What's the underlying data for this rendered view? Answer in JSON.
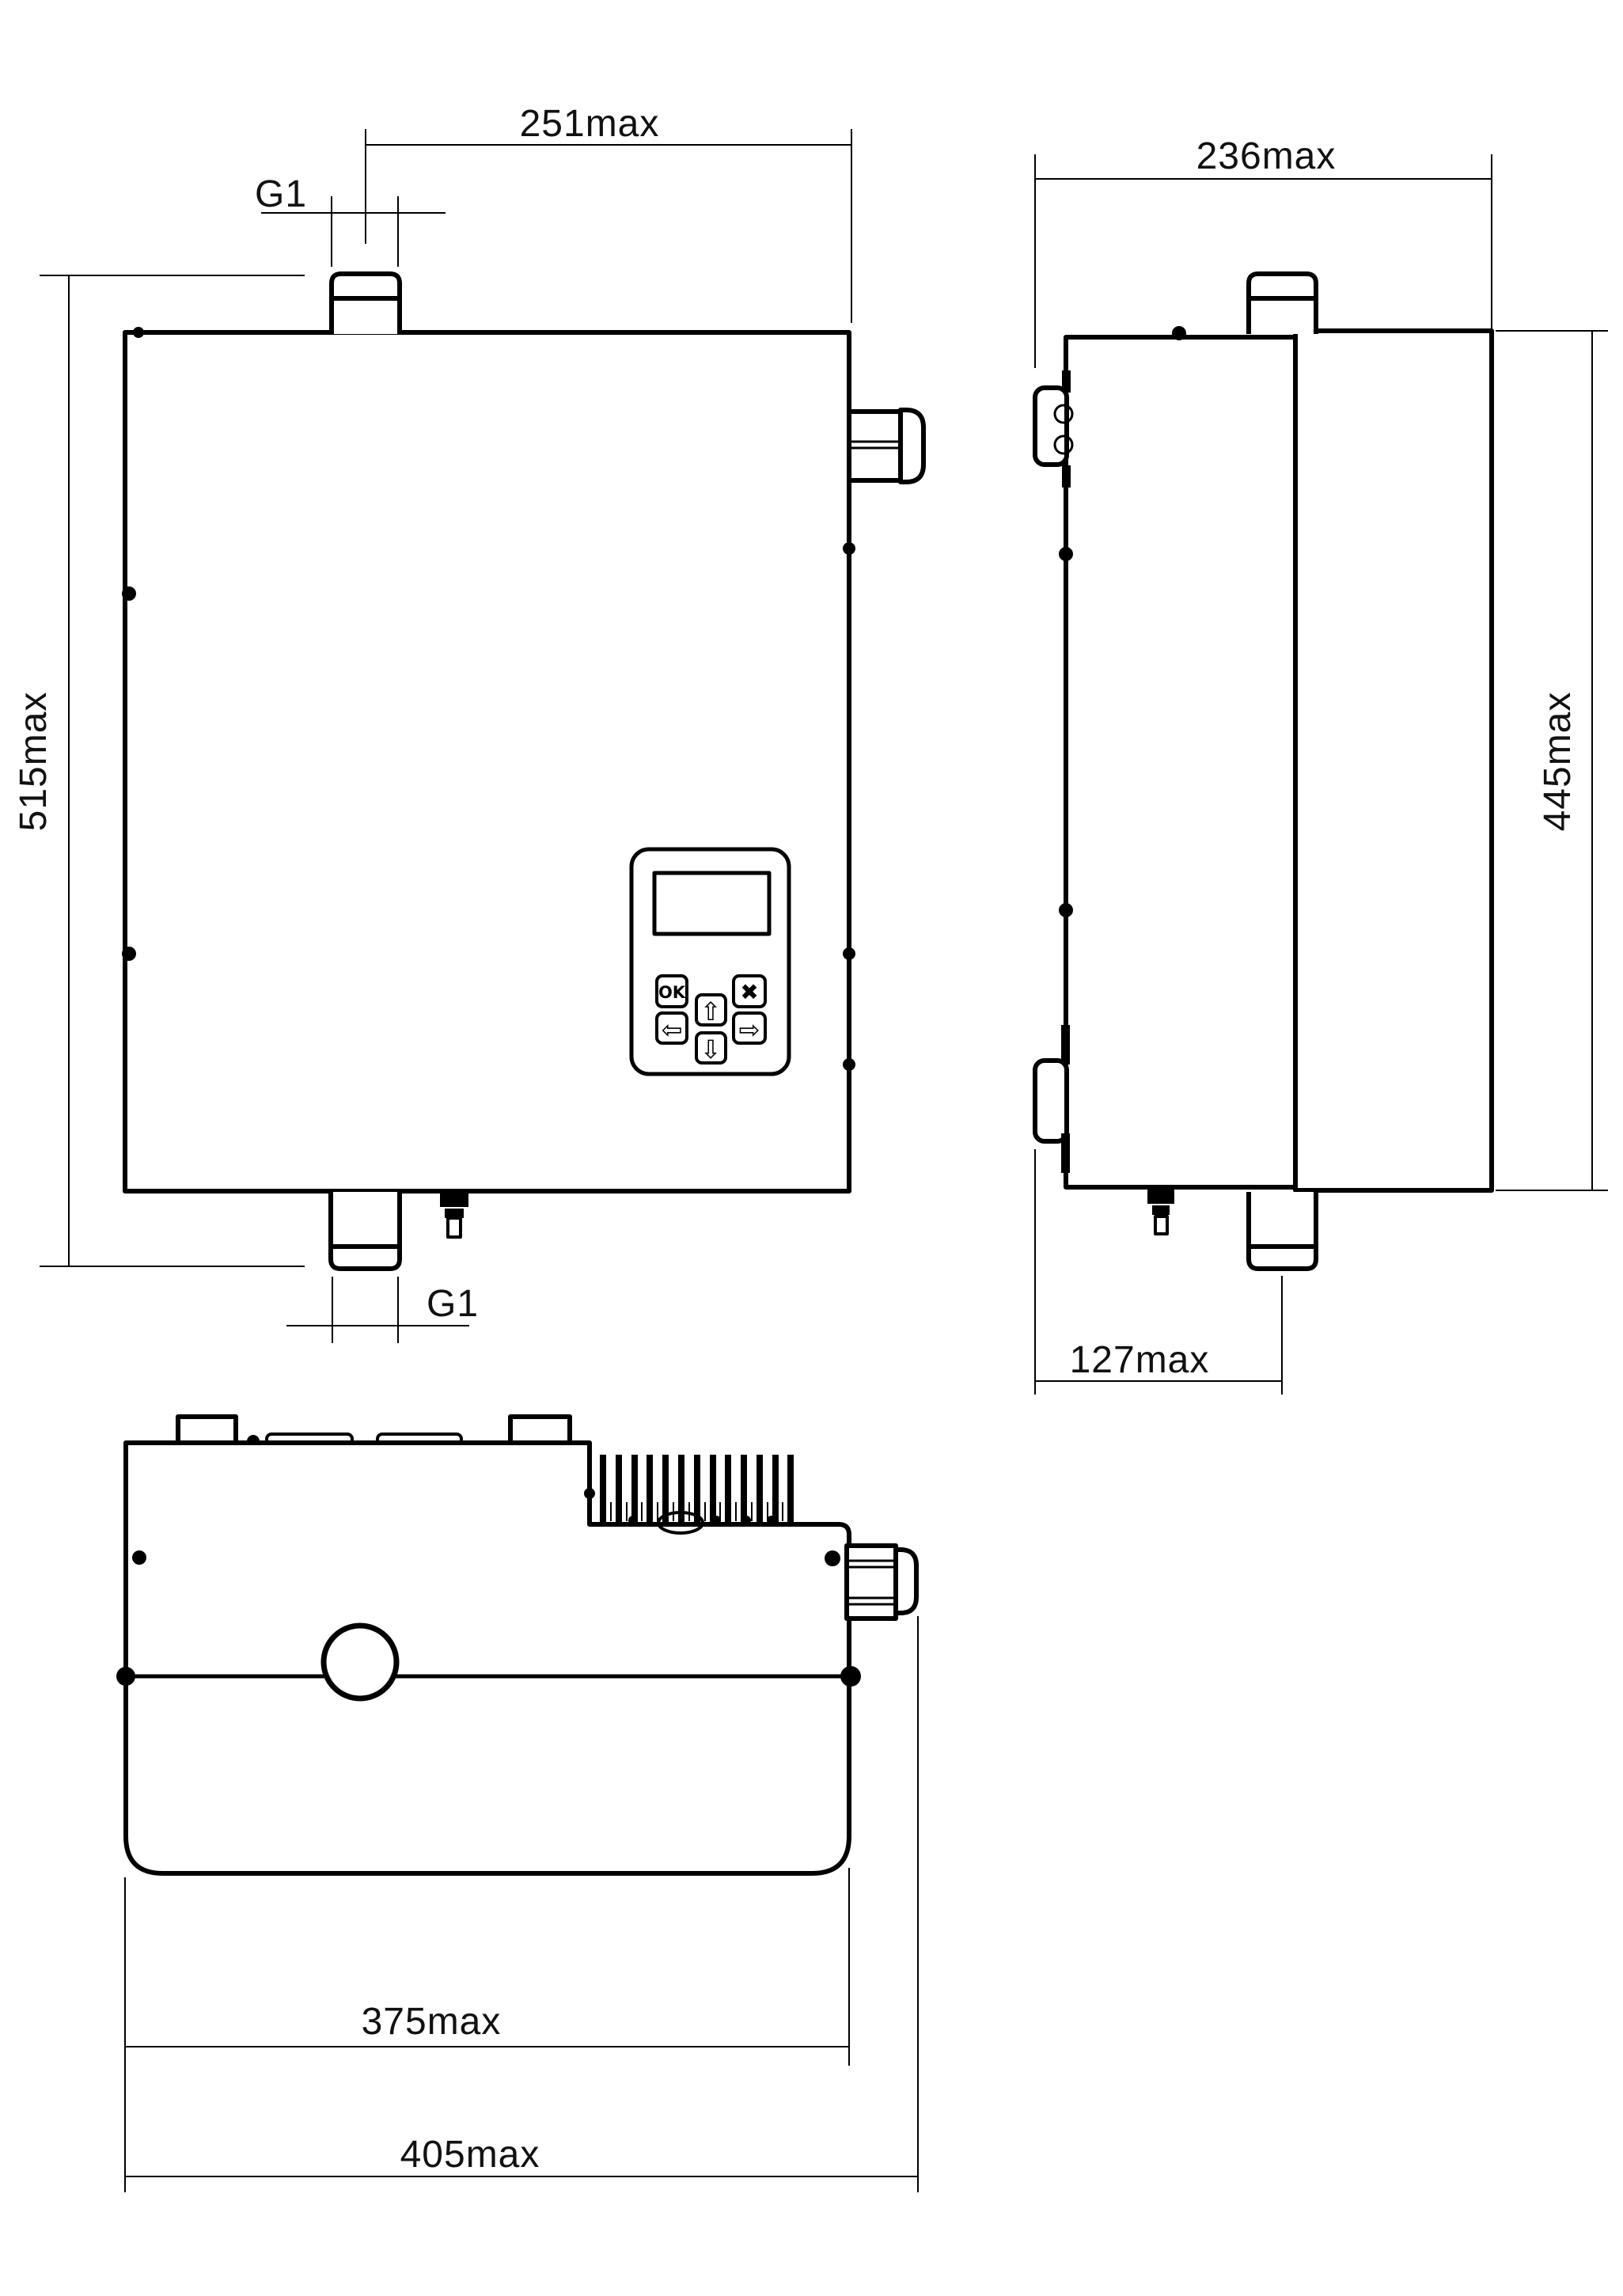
{
  "drawing": {
    "front_view": {
      "width_dim": "251max",
      "height_dim": "515max",
      "top_port_label": "G1",
      "bottom_port_label": "G1",
      "control_panel": {
        "ok_button": "OK",
        "cancel_button": "✖",
        "up_button": "⇧",
        "down_button": "⇩",
        "left_button": "⇦",
        "right_button": "⇨"
      }
    },
    "side_view": {
      "depth_dim": "236max",
      "height_dim": "445max",
      "pipe_offset_dim": "127max"
    },
    "top_view": {
      "body_width_dim": "375max",
      "overall_width_dim": "405max"
    },
    "colors": {
      "line": "#000000",
      "background": "#ffffff"
    }
  }
}
